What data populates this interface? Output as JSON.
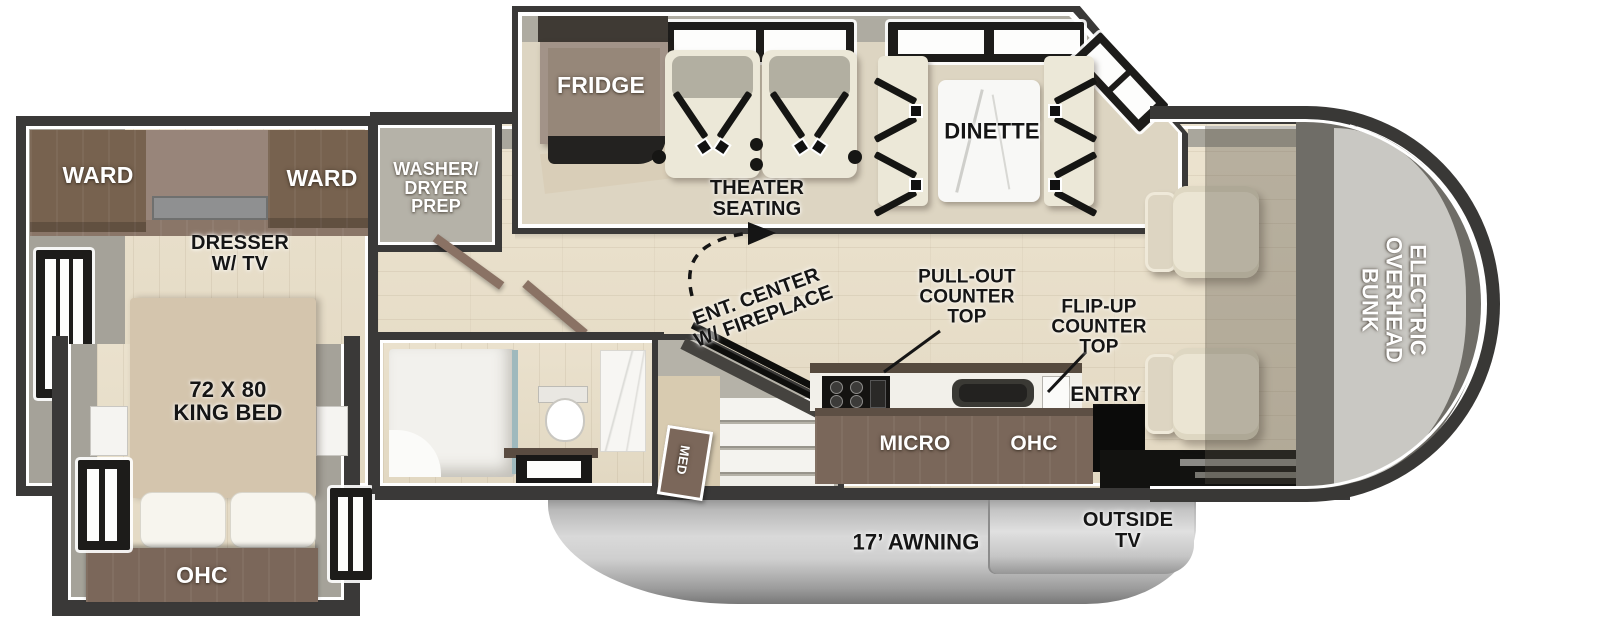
{
  "palette": {
    "wall": "#3a3938",
    "floor_wood": "#e9e0cc",
    "floor_gray": "#a9a69c",
    "cabinet_brown": "#7b675a",
    "seat_cream": "#ece8d8",
    "awning_gray": "#c9c9c9",
    "label_black": "#151515",
    "label_white": "#ffffff"
  },
  "bedroom": {
    "ward_left": "WARD",
    "ward_right": "WARD",
    "dresser_tv": "DRESSER\nW/ TV",
    "king_bed": "72 X 80\nKING BED",
    "ohc": "OHC"
  },
  "utility": {
    "washer_dryer_prep": "WASHER/\nDRYER\nPREP",
    "med_cabinet": "MED"
  },
  "living": {
    "fridge": "FRIDGE",
    "theater_seating": "THEATER\nSEATING",
    "dinette": "DINETTE",
    "ent_center": "ENT. CENTER\nW/ FIREPLACE"
  },
  "kitchen": {
    "pull_out_counter": "PULL-OUT\nCOUNTER\nTOP",
    "flip_up_counter": "FLIP-UP\nCOUNTER\nTOP",
    "entry": "ENTRY",
    "micro": "MICRO",
    "ohc": "OHC"
  },
  "cab": {
    "overhead_bunk": "ELECTRIC\nOVERHEAD\nBUNK"
  },
  "exterior": {
    "awning": "17’ AWNING",
    "outside_tv": "OUTSIDE\nTV"
  }
}
